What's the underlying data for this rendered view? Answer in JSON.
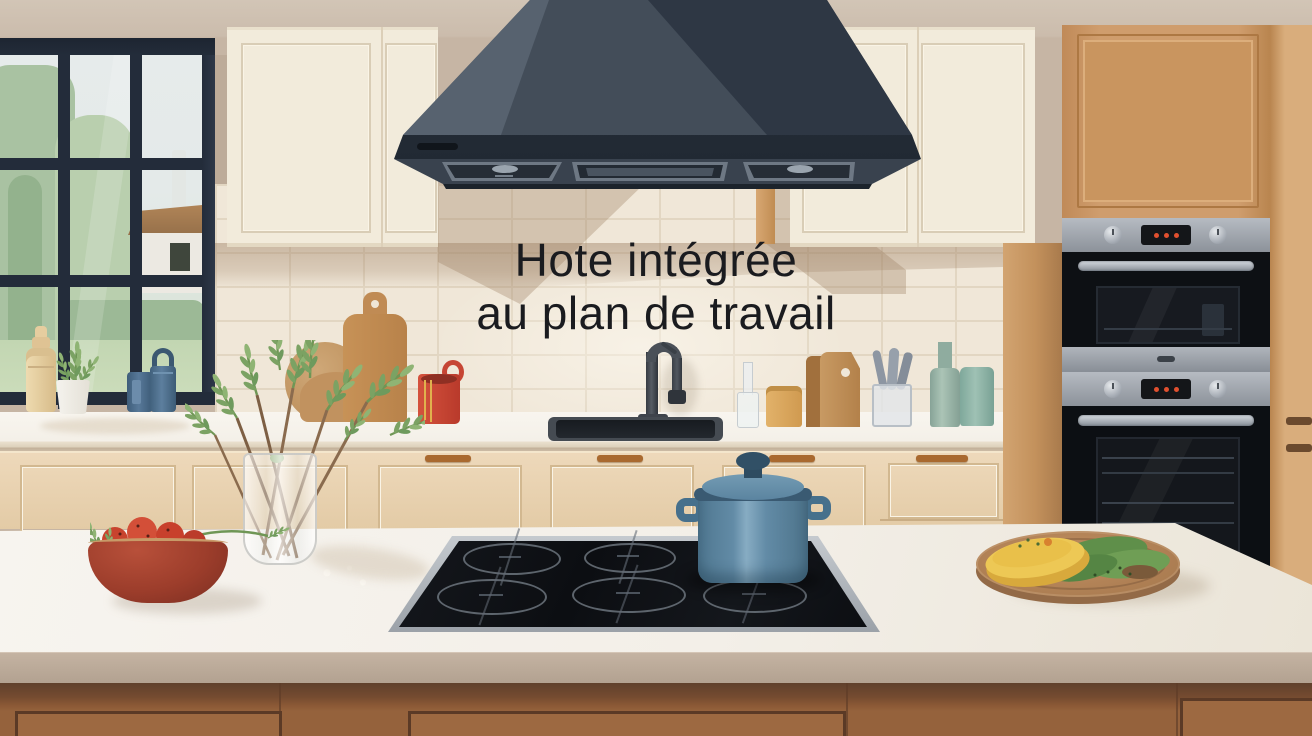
{
  "caption": {
    "line1": "Hote intégrée",
    "line2": "au plan de travail"
  },
  "palette": {
    "wall": "#c8b8a8",
    "cabinet_cream": "#f2ebdb",
    "tile": "#f0e7d8",
    "grout": "#e2d6c2",
    "hood_dark": "#2e3744",
    "hood_mid": "#434d59",
    "hood_light": "#57626f",
    "wood_cabinet": "#cf9d6d",
    "steel": "#a6acb3",
    "oven_black": "#0d1014",
    "display_dot_red": "#e0502f",
    "counter_white": "#f6f3ed",
    "base_cabinet": "#e7d1b1",
    "handle_wood": "#a9692f",
    "island_band": "#b8a796",
    "island_wood": "#95623c",
    "pot_blue": "#628ba6",
    "cooktop_black": "#101318",
    "tomato_red": "#c8402c",
    "bowl_terracotta": "#a8402e",
    "herb_green": "#7ba263",
    "window_frame": "#232c3a"
  }
}
